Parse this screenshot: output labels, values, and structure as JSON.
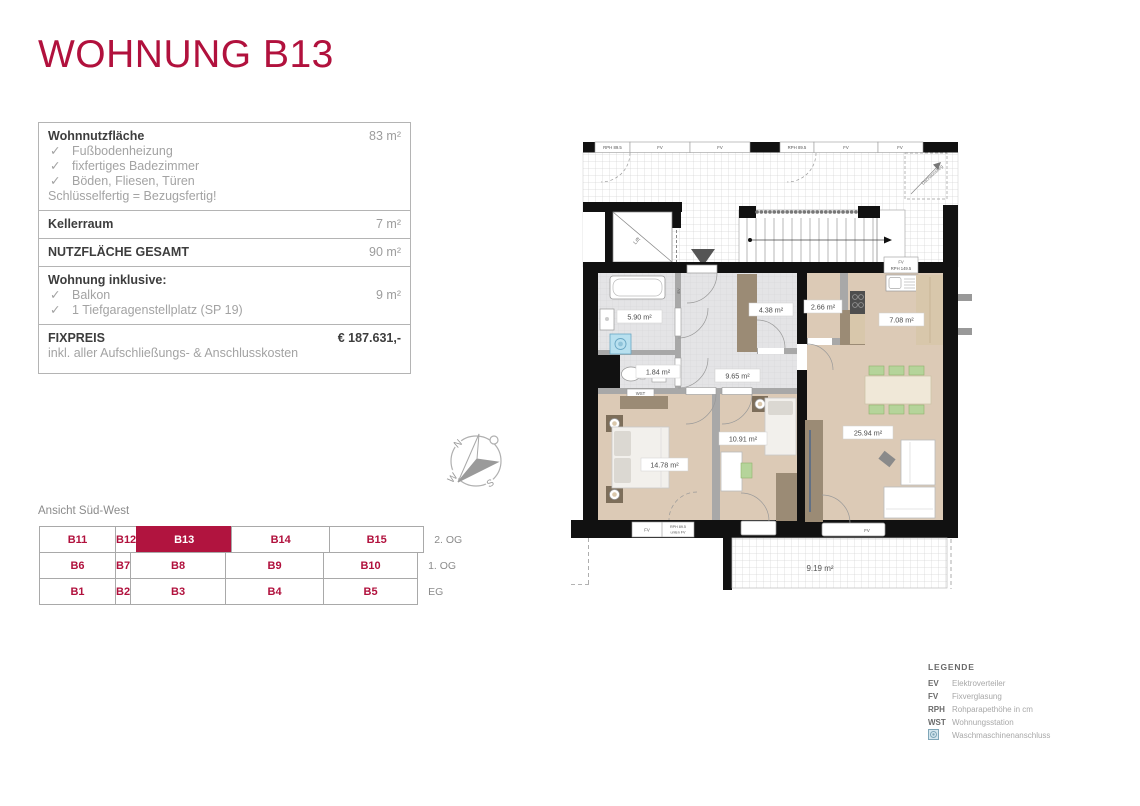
{
  "colors": {
    "accent_red": "#B1123E",
    "wall_black": "#111111",
    "floor_beige": "#DCCAB6",
    "floor_tile_gray": "#E4E4E6",
    "furniture_tan": "#9B8B75",
    "chair_green": "#B5D49A",
    "washer_blue": "#B8E0EF"
  },
  "page": {
    "title": "WOHNUNG B13"
  },
  "info_box": {
    "check_glyph": "✓",
    "wohnnutzflaeche": {
      "label": "Wohnnutzfläche",
      "value": "83 m²"
    },
    "features": [
      "Fußbodenheizung",
      "fixfertiges Badezimmer",
      "Böden, Fliesen, Türen"
    ],
    "note": "Schlüsselfertig = Bezugsfertig!",
    "kellerraum": {
      "label": "Kellerraum",
      "value": "7 m²"
    },
    "gesamt": {
      "label": "NUTZFLÄCHE GESAMT",
      "value": "90 m²"
    },
    "inklusive": {
      "label": "Wohnung inklusive:",
      "items": [
        {
          "label": "Balkon",
          "value": "9 m²"
        },
        {
          "label": "1 Tiefgaragenstellplatz (SP 19)",
          "value": ""
        }
      ]
    },
    "fixpreis": {
      "label": "FIXPREIS",
      "value": "€ 187.631,-",
      "note": "inkl. aller Aufschließungs- & Anschlusskosten"
    }
  },
  "view_label": "Ansicht Süd-West",
  "compass": {
    "north": "N",
    "south": "S",
    "west": "W"
  },
  "unit_grid": {
    "selected_unit": "B13",
    "rows": [
      {
        "floor": "2. OG",
        "cells": [
          "B11",
          "B12",
          "B13",
          "B14",
          "B15"
        ]
      },
      {
        "floor": "1. OG",
        "cells": [
          "B6",
          "B7",
          "B8",
          "B9",
          "B10"
        ]
      },
      {
        "floor": "EG",
        "cells": [
          "B1",
          "B2",
          "B3",
          "B4",
          "B5"
        ]
      }
    ]
  },
  "floorplan": {
    "rooms": {
      "bathroom": "5.90 m²",
      "wc": "1.84 m²",
      "hall": "9.65 m²",
      "storage": "4.38 m²",
      "pantry": "2.66 m²",
      "kitchen": "7.08 m²",
      "bedroom1": "14.78 m²",
      "bedroom2": "10.91 m²",
      "living": "25.94 m²",
      "balcony": "9.19 m²"
    },
    "labels": {
      "lift": "Lift",
      "roof_exit": "Dachausstieg",
      "wst": "WST",
      "ev": "EV",
      "fv": "FV",
      "rph_895": "RPH 89.5",
      "rph_1495": "RPH 149.5",
      "unten_fv": "unten FV"
    }
  },
  "legend": {
    "title": "LEGENDE",
    "items": [
      {
        "abbr": "EV",
        "desc": "Elektroverteiler"
      },
      {
        "abbr": "FV",
        "desc": "Fixverglasung"
      },
      {
        "abbr": "RPH",
        "desc": "Rohparapethöhe in cm"
      },
      {
        "abbr": "WST",
        "desc": "Wohnungsstation"
      },
      {
        "abbr": "",
        "desc": "Waschmaschinenanschluss"
      }
    ]
  }
}
